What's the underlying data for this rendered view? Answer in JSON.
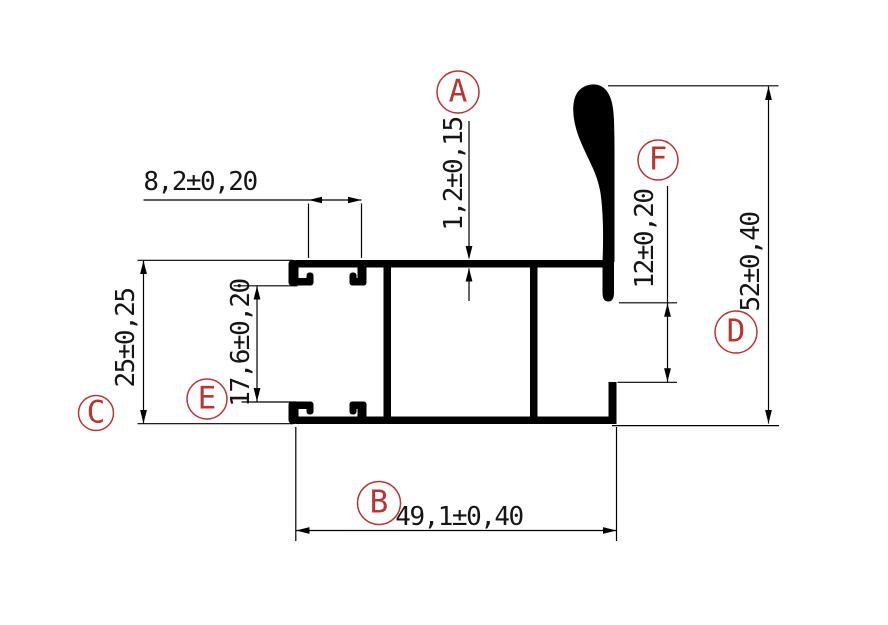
{
  "colors": {
    "background": "#ffffff",
    "profile_fill": "#000000",
    "dimension_line": "#000000",
    "dimension_text": "#151515",
    "callout_red": "#b53632"
  },
  "callouts": [
    {
      "letter": "A"
    },
    {
      "letter": "B"
    },
    {
      "letter": "C"
    },
    {
      "letter": "D"
    },
    {
      "letter": "E"
    },
    {
      "letter": "F"
    }
  ],
  "dimensions": {
    "groove_width": "8,2±0,20",
    "wall_thickness": "1,2±0,15",
    "body_height": "25±0,25",
    "channel_inner_height": "17,6±0,20",
    "fin_to_step": "12±0,20",
    "overall_height": "52±0,40",
    "overall_width": "49,1±0,40"
  }
}
